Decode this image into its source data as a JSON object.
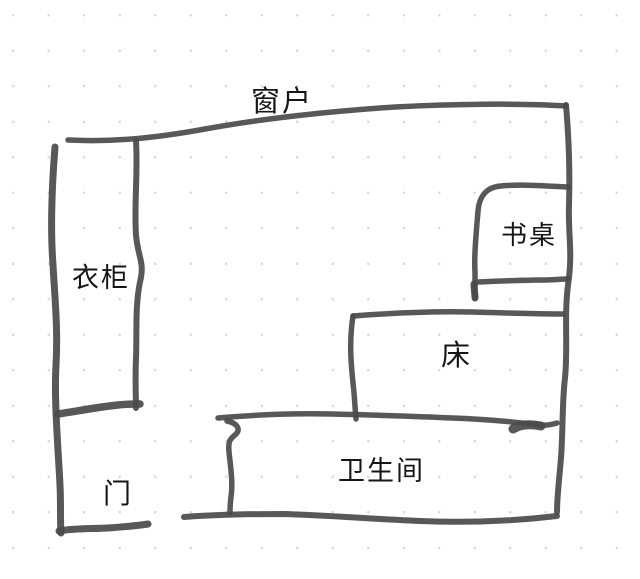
{
  "canvas": {
    "background": "#ffffff",
    "dot_color": "#dadada",
    "ink": "#4a4a4a",
    "text_color": "#161616"
  },
  "labels": {
    "window": "窗户",
    "wardrobe": "衣柜",
    "desk": "书桌",
    "bed": "床",
    "bathroom": "卫生间",
    "door": "门"
  }
}
